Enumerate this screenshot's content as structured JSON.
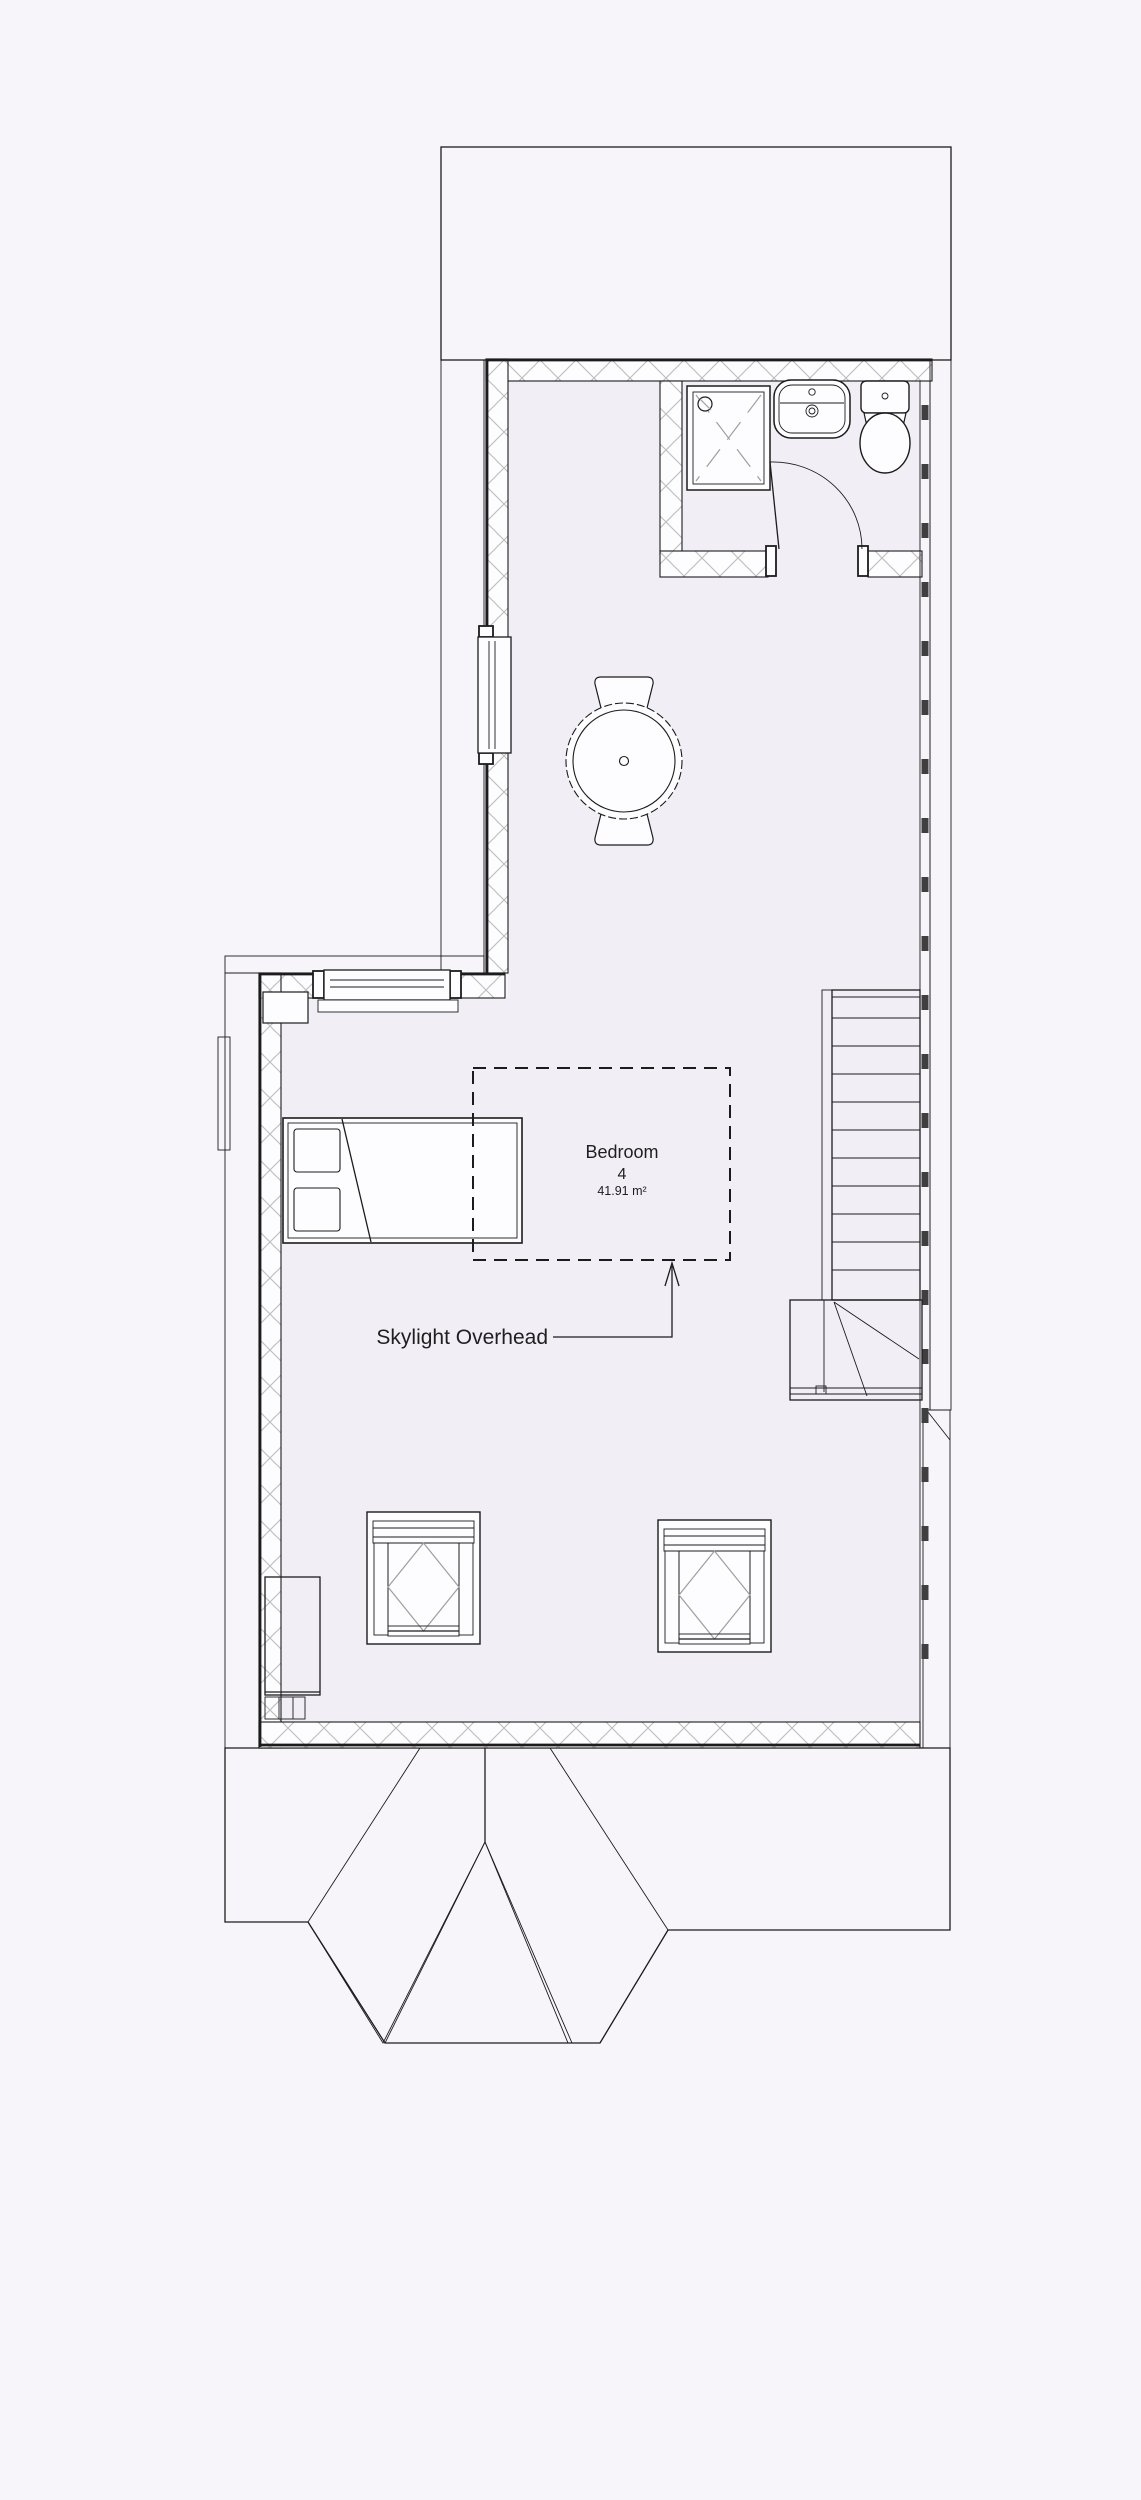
{
  "room": {
    "name": "Bedroom",
    "number": "4",
    "area": "41.91 m²"
  },
  "annotation": {
    "skylight": "Skylight Overhead"
  },
  "colors": {
    "background": "#f8f5fa",
    "interior": "#f1eef6",
    "line": "#1c1c1c",
    "hatch": "#bcbcbc",
    "brick_joint": "#3c3c3c",
    "furniture_fill": "#fdfcfe",
    "accent_gray": "#9f9f9f",
    "text": "#1f1f1f"
  },
  "features": [
    "roof-tiles",
    "hip-roof-bay",
    "exterior-wall",
    "bathroom",
    "shower",
    "washbasin",
    "toilet",
    "door-swing",
    "window",
    "round-table",
    "dining-chair",
    "bed",
    "pillow",
    "skylight-outline",
    "stairs",
    "winder-landing",
    "armchair",
    "wardrobe",
    "chimney"
  ]
}
